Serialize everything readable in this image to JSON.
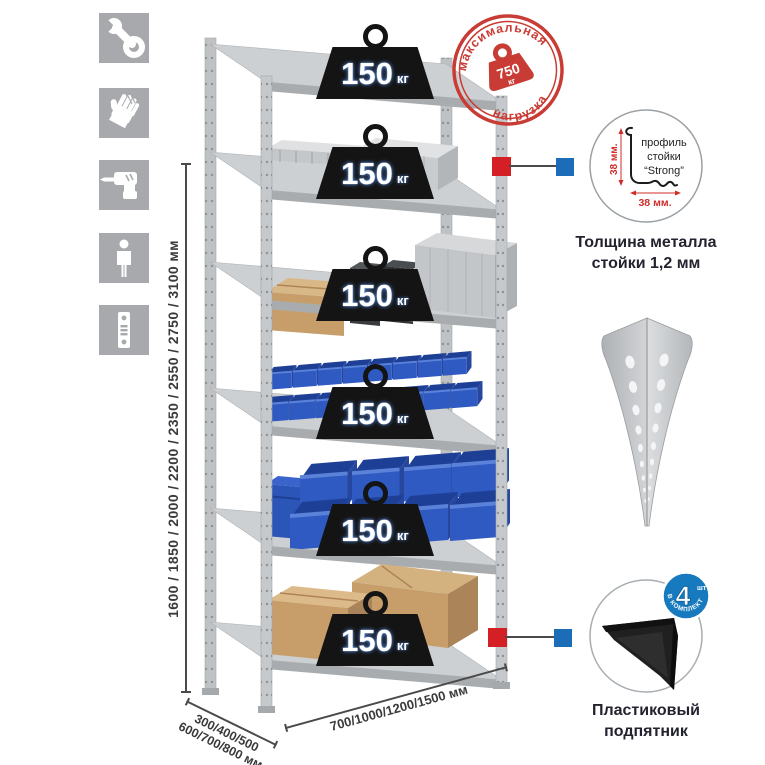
{
  "sidebar": {
    "items": [
      {
        "icon": "wrench-icon"
      },
      {
        "icon": "gloves-icon"
      },
      {
        "icon": "drill-icon"
      },
      {
        "icon": "person-icon"
      },
      {
        "icon": "rack-post-icon"
      }
    ]
  },
  "dimensions": {
    "height_label": "1600 / 1850 / 2000 / 2200 / 2350 / 2550 / 2750 / 3100 мм",
    "depth_label_line1": "300/400/500",
    "depth_label_line2": "600/700/800 мм",
    "width_label": "700/1000/1200/1500 мм"
  },
  "rack": {
    "badges": [
      {
        "value": "150",
        "unit": "кг"
      },
      {
        "value": "150",
        "unit": "кг"
      },
      {
        "value": "150",
        "unit": "кг"
      },
      {
        "value": "150",
        "unit": "кг"
      },
      {
        "value": "150",
        "unit": "кг"
      },
      {
        "value": "150",
        "unit": "кг"
      }
    ]
  },
  "stamp": {
    "arc_top": "максимальная",
    "arc_bottom": "нагрузка",
    "weight_value": "750",
    "weight_unit": "кг"
  },
  "profile_detail": {
    "dim_vertical": "38 мм.",
    "dim_horizontal": "38 мм.",
    "label_line1": "профиль",
    "label_line2": "стойки",
    "label_line3": "“Strong”",
    "caption_line1": "Толщина металла",
    "caption_line2": "стойки 1,2 мм"
  },
  "foot_detail": {
    "badge_value": "4",
    "badge_unit": "шт",
    "badge_arc": "В КОМПЛЕКТЕ",
    "caption_line1": "Пластиковый",
    "caption_line2": "подпятник"
  },
  "colors": {
    "accent_red": "#d42025",
    "accent_blue": "#1a6db6",
    "stamp_red": "#c93c35",
    "bin_blue": "#2f5ac2",
    "metal_gray": "#c7c9cb",
    "cardboard": "#c79e6a",
    "badge_black": "#141414",
    "icon_gray": "#a7a9ac"
  }
}
